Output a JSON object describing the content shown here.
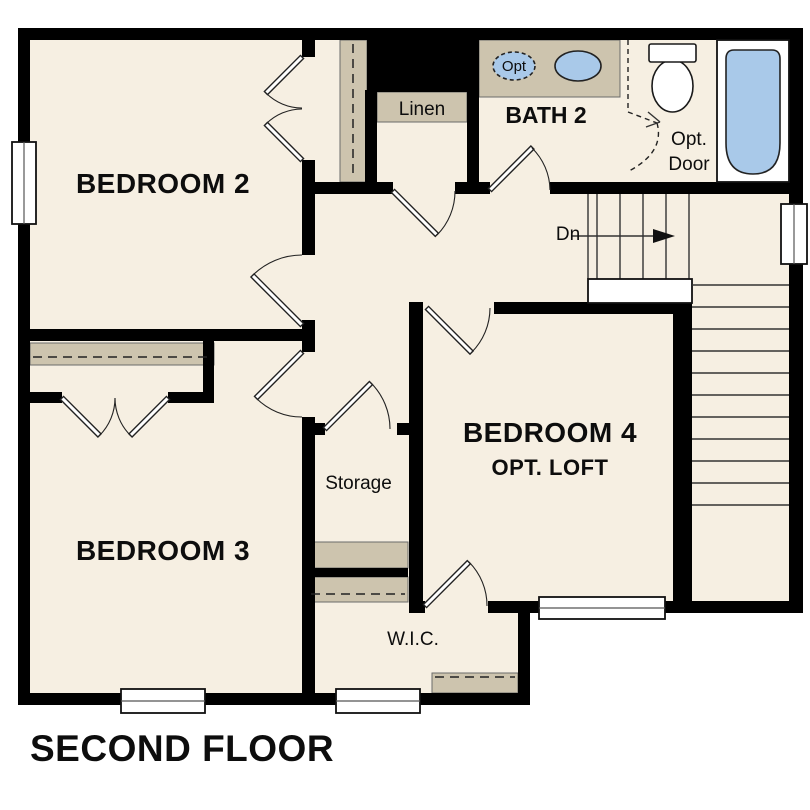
{
  "title": "SECOND FLOOR",
  "colors": {
    "wall": "#000000",
    "floor": "#f6efe2",
    "shelf": "#cdc4ae",
    "fixture": "#a9c9e9"
  },
  "rooms": {
    "bedroom2": {
      "label": "BEDROOM 2"
    },
    "bedroom3": {
      "label": "BEDROOM 3"
    },
    "bedroom4": {
      "label": "BEDROOM 4",
      "sublabel": "OPT. LOFT"
    },
    "bath2": {
      "label": "BATH 2"
    },
    "linen": {
      "label": "Linen"
    },
    "storage": {
      "label": "Storage"
    },
    "wic": {
      "label": "W.I.C."
    }
  },
  "annotations": {
    "stairs_direction": "Dn",
    "optional_door": [
      "Opt.",
      "Door"
    ],
    "optional_sink": "Opt"
  }
}
